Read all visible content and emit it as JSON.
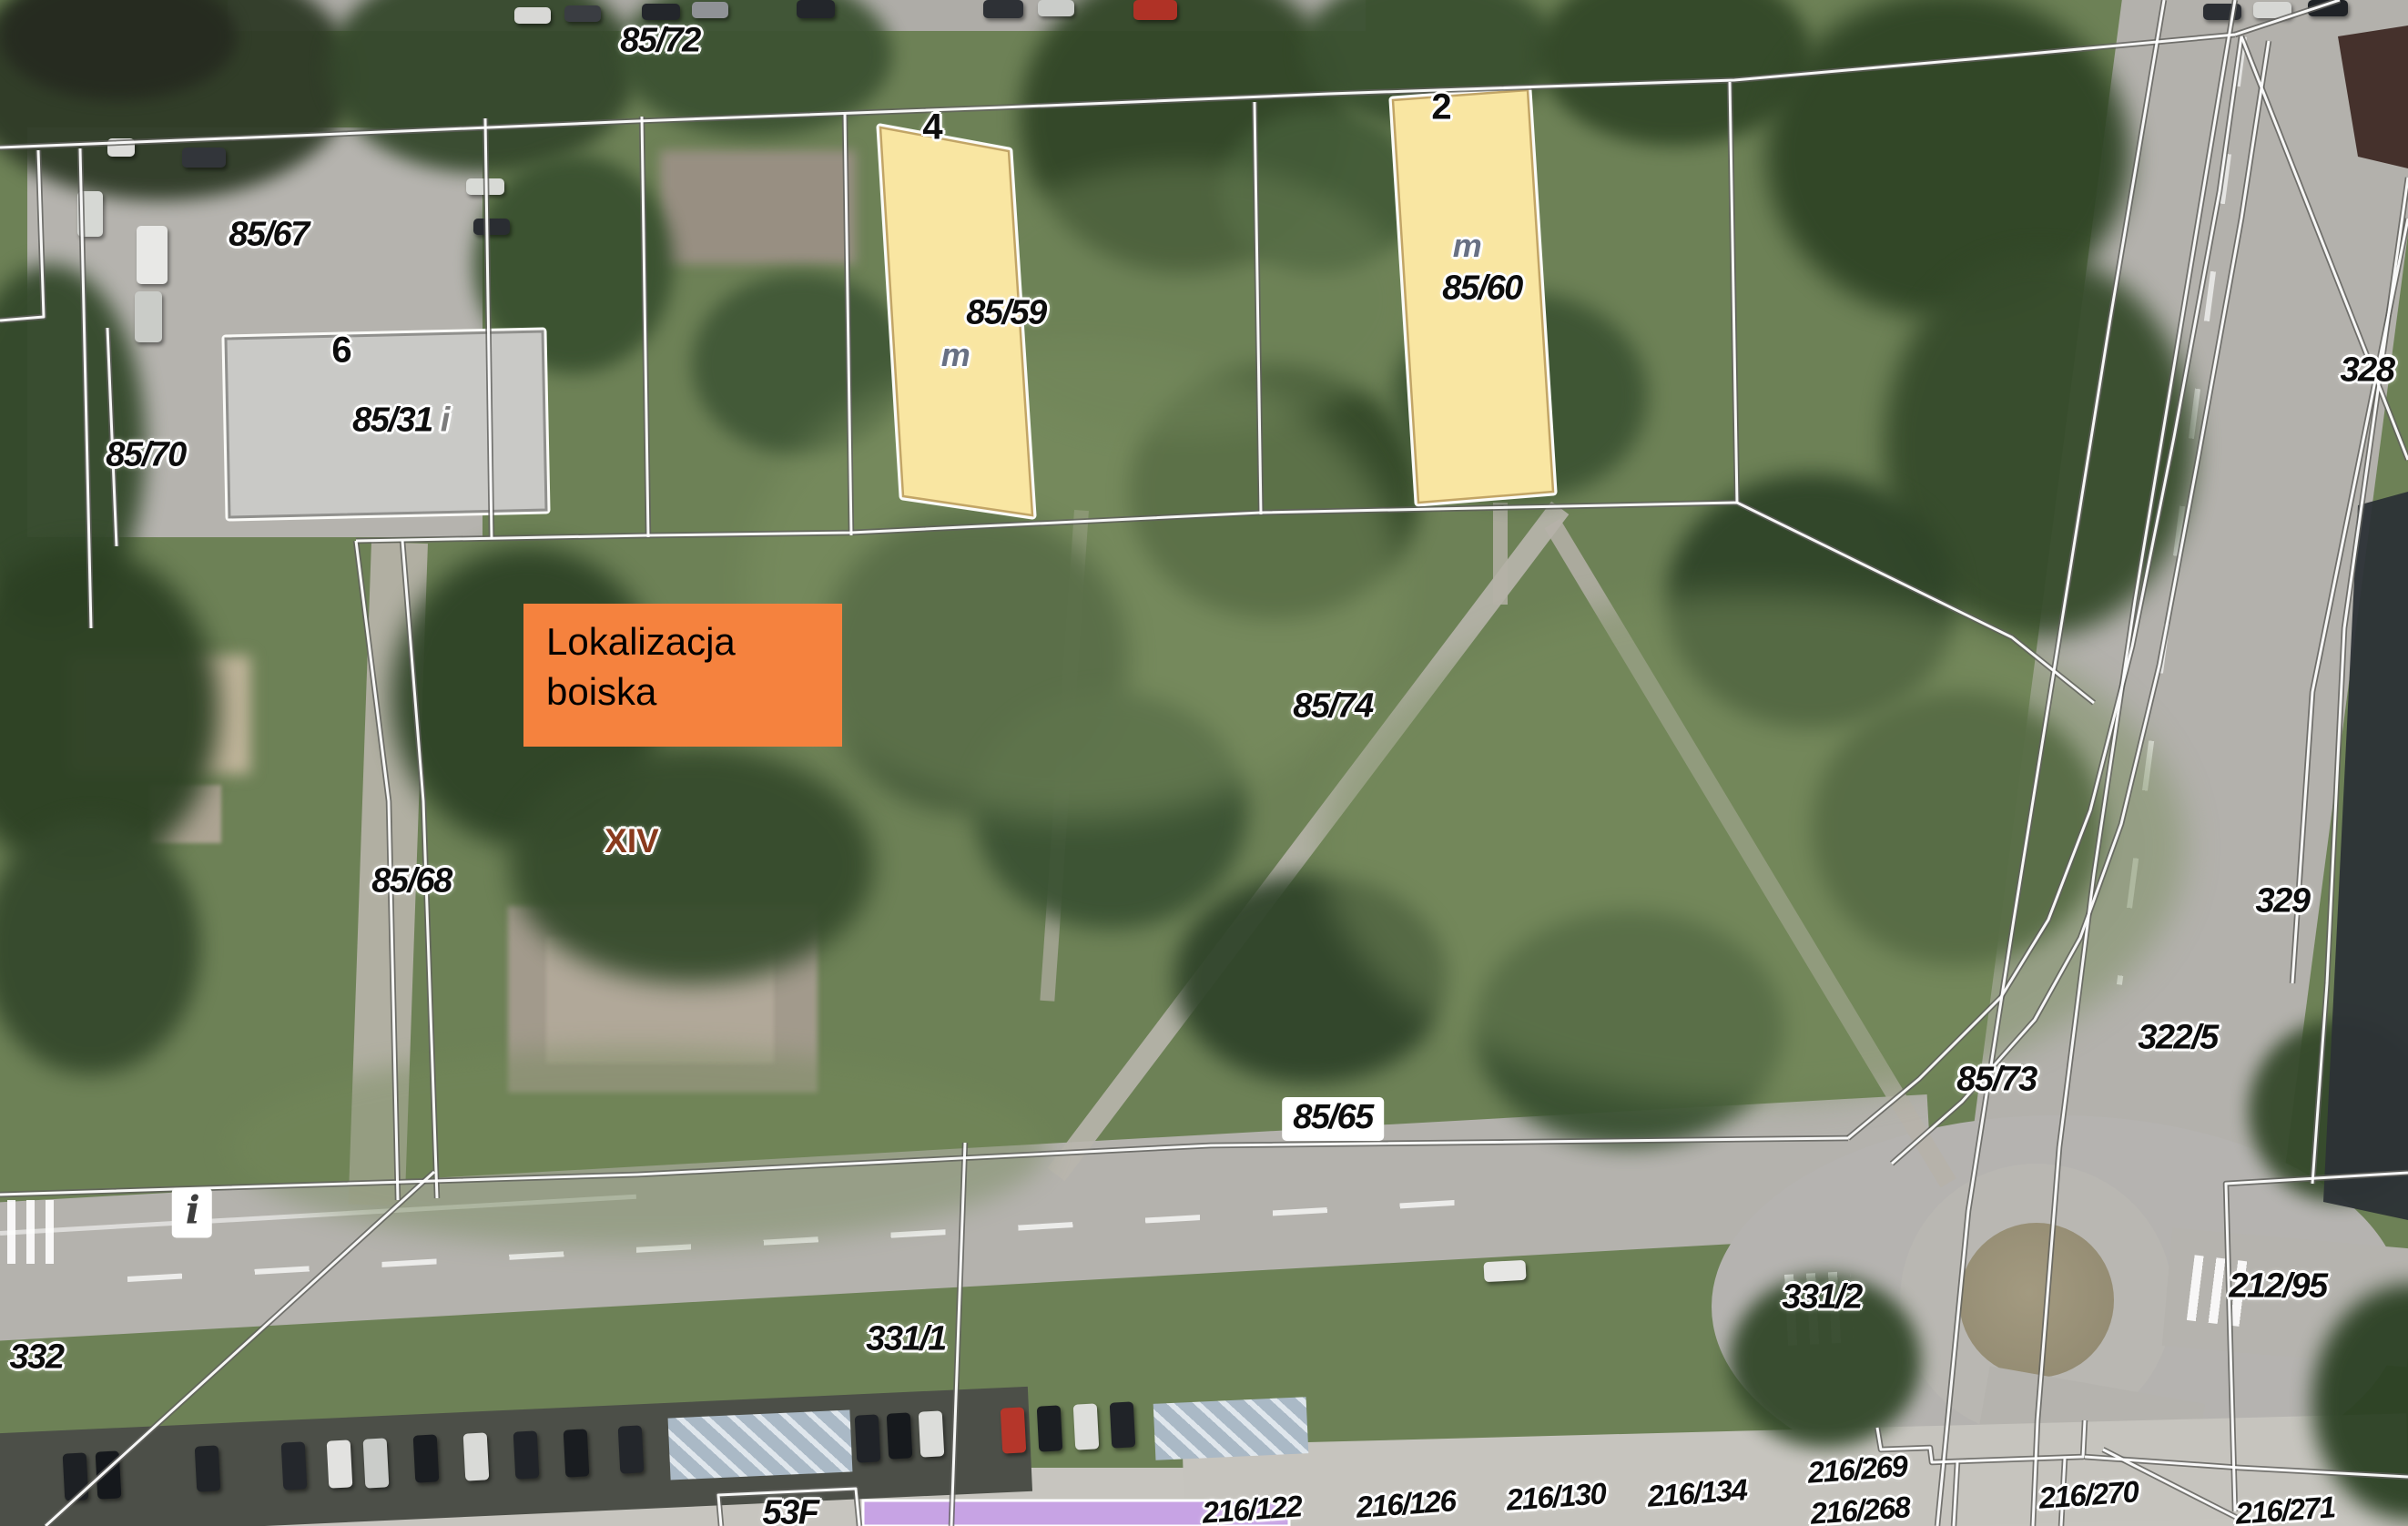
{
  "map": {
    "description": "Aerial cadastral map with parcel boundaries and site annotation",
    "annotation": {
      "line1": "Lokalizacja",
      "line2": "boiska"
    },
    "district_label": "XIV",
    "info_symbol": "i",
    "parcel_suffix_i": "i",
    "parcels": {
      "p85_72": "85/72",
      "p85_67": "85/67",
      "p85_70": "85/70",
      "p85_68": "85/68",
      "p85_74": "85/74",
      "p85_65": "85/65",
      "p85_73": "85/73",
      "p85_59": "85/59",
      "p85_60": "85/60",
      "p85_31": "85/31",
      "p322_5": "322/5",
      "p328": "328",
      "p329": "329",
      "p332": "332",
      "p331_1": "331/1",
      "p331_2": "331/2",
      "p212_95": "212/95",
      "p216_122": "216/122",
      "p216_126": "216/126",
      "p216_130": "216/130",
      "p216_134": "216/134",
      "p216_268": "216/268",
      "p216_269": "216/269",
      "p216_270": "216/270",
      "p216_271": "216/271"
    },
    "building_numbers": {
      "gray": "6",
      "yellow_left": "4",
      "yellow_right": "2",
      "bottom": "53F"
    },
    "usage_marks": {
      "yellow_left": "m",
      "yellow_right": "m"
    }
  },
  "colors": {
    "annotation_box": "#f5823e",
    "building_yellow": "#f9e6a2",
    "building_gray": "#c9c9c6",
    "building_purple": "#c7a3e4",
    "district_label": "#8a3a1d",
    "usage_mark": "#687083",
    "parcel_line": "#ffffff",
    "label_text": "#0d0d0d"
  }
}
